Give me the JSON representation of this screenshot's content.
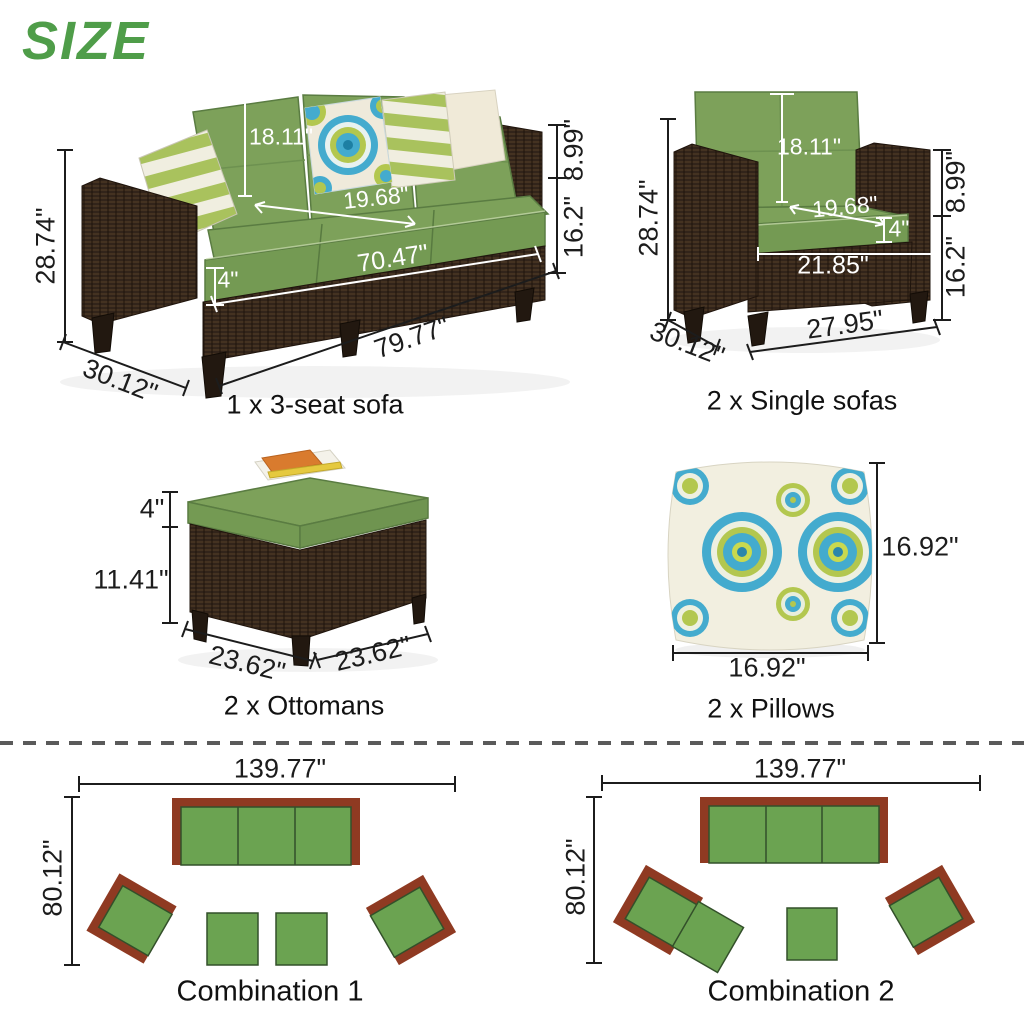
{
  "title": "SIZE",
  "items": {
    "sofa3": {
      "caption": "1 x 3-seat sofa",
      "back_cushion_height": "18.11\"",
      "seat_depth": "19.68\"",
      "cushion_thickness": "4\"",
      "seat_width": "70.47\"",
      "overall_width": "79.77\"",
      "overall_depth": "30.12\"",
      "overall_height": "28.74\"",
      "arm_to_seat": "8.99\"",
      "seat_to_ground": "16.2\""
    },
    "single_sofa": {
      "caption": "2 x Single sofas",
      "back_cushion_height": "18.11\"",
      "seat_depth": "19.68\"",
      "cushion_thickness": "4\"",
      "seat_width": "21.85\"",
      "overall_width": "27.95\"",
      "overall_depth": "30.12\"",
      "overall_height": "28.74\"",
      "arm_to_seat": "8.99\"",
      "seat_to_ground": "16.2\""
    },
    "ottoman": {
      "caption": "2 x Ottomans",
      "cushion_thickness": "4\"",
      "base_height": "11.41\"",
      "width": "23.62\"",
      "depth": "23.62\""
    },
    "pillow": {
      "caption": "2 x Pillows",
      "height": "16.92\"",
      "width": "16.92\""
    },
    "combination1": {
      "caption": "Combination 1",
      "layout_width": "139.77\"",
      "layout_depth": "80.12\""
    },
    "combination2": {
      "caption": "Combination 2",
      "layout_width": "139.77\"",
      "layout_depth": "80.12\""
    }
  },
  "colors": {
    "title_green": "#4f9d49",
    "cushion_green": "#7da15a",
    "wicker_brown": "#32241a",
    "plan_green": "#6ba351",
    "plan_brown": "#8f3a22",
    "pillow_teal": "#44abce",
    "stripe_green": "#a9c25d",
    "dim_dark": "#1c1c1c",
    "dim_light": "#ffffff"
  }
}
